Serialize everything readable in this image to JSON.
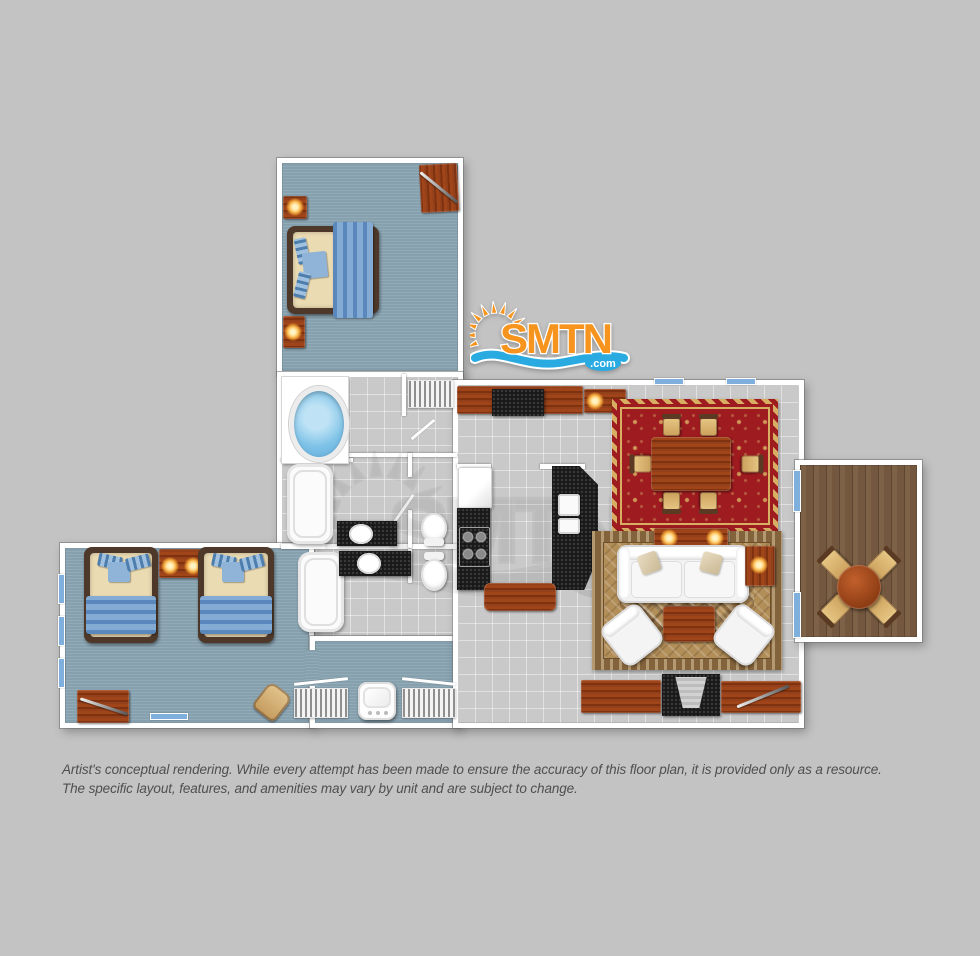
{
  "page": {
    "background_color": "#C3C3C3"
  },
  "logo": {
    "brand": "SMTN",
    "tld": ".com",
    "colors": {
      "orange": "#F7941D",
      "wave_blue": "#29ABE2",
      "outline": "#FFFFFF"
    }
  },
  "watermark": {
    "of": "smtn-logo",
    "opacity": 0.1
  },
  "floorplan": {
    "rooms": [
      {
        "id": "master-bedroom",
        "floor": "carpet"
      },
      {
        "id": "bathrooms-hall",
        "floor": "tile"
      },
      {
        "id": "guest-bedroom",
        "floor": "carpet"
      },
      {
        "id": "kitchen-dining-living",
        "floor": "tile"
      },
      {
        "id": "deck",
        "floor": "wood-planks"
      }
    ],
    "palette": {
      "carpet_blue": "#8CA7B5",
      "tile_gray": "#C9C9C9",
      "wall_white": "#FFFFFF",
      "furniture_wood": "#A0451A",
      "deck_wood": "#7D6248",
      "rug_red": "#9E1B20",
      "rug_gold": "#D8AE62",
      "rug_tan": "#B28E59",
      "tub_water_blue": "#7FC3E8",
      "counter_black": "#1A1A1A",
      "window_blue": "#7FAFDD",
      "lamp_glow": "#FFC45E"
    }
  },
  "disclaimer": {
    "line1": "Artist's conceptual rendering. While every attempt has been made to ensure the accuracy of this floor plan, it is provided only as a resource.",
    "line2": "The specific layout, features, and amenities may vary by unit and are subject to change."
  }
}
